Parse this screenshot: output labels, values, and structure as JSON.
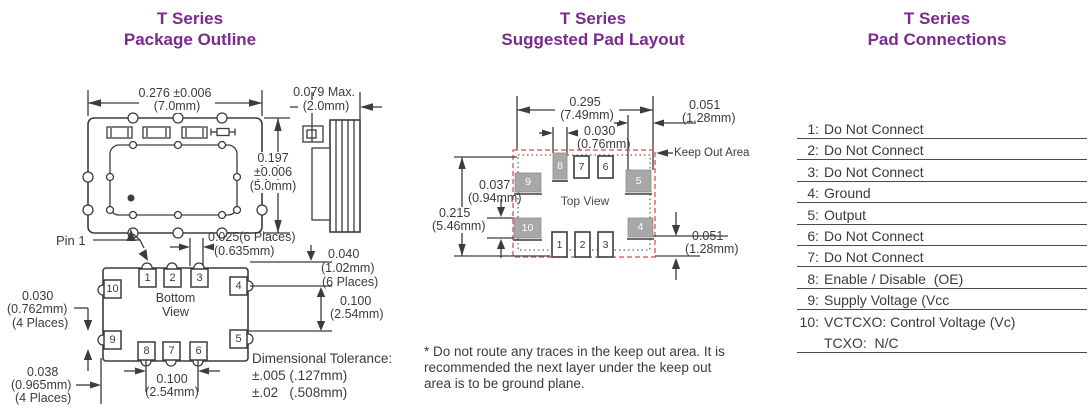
{
  "palette": {
    "purple": "#7a2b8d",
    "ink": "#3b3b3b",
    "pad_gray": "#a8a8a8",
    "keepout_red": "#e26a63"
  },
  "outline": {
    "title1": "T Series",
    "title2": "Package Outline",
    "pin1": "Pin 1",
    "view_label1": "Bottom",
    "view_label2": "View",
    "dims": {
      "width": "0.276 ±0.006",
      "width_mm": "(7.0mm)",
      "height1": "0.197",
      "height2": "±0.006",
      "height3": "(5.0mm)",
      "thick": "0.079 Max.",
      "thick_mm": "(2.0mm)",
      "pad_w": "0.025(6 Places)",
      "pad_w_mm": "(0.635mm)",
      "pad_l": "0.040",
      "pad_l_mm": "(1.02mm)",
      "pad_l_places": "(6 Places)",
      "pitch_r": "0.100",
      "pitch_r_mm": "(2.54mm)",
      "side_pad": "0.030",
      "side_pad_mm": "(0.762mm)",
      "side_pad_places": "(4 Places)",
      "corner": "0.038",
      "corner_mm": "(0.965mm)",
      "corner_places": "(4 Places)",
      "pitch_b": "0.100",
      "pitch_b_mm": "(2.54mm)"
    },
    "tolerance": {
      "line1": "Dimensional Tolerance:",
      "line2": "±.005 (.127mm)",
      "line3": "±.02   (.508mm)"
    },
    "pads": {
      "p1": "1",
      "p2": "2",
      "p3": "3",
      "p4": "4",
      "p5": "5",
      "p6": "6",
      "p7": "7",
      "p8": "8",
      "p9": "9",
      "p10": "10"
    }
  },
  "pad_layout": {
    "title1": "T Series",
    "title2": "Suggested Pad Layout",
    "view_label": "Top View",
    "keep_out": "Keep Out Area",
    "dims": {
      "width": "0.295",
      "width_mm": "(7.49mm)",
      "pad_w": "0.030",
      "pad_w_mm": "(0.76mm)",
      "pad51_top": "0.051",
      "pad51_top_mm": "(1.28mm)",
      "pad37": "0.037",
      "pad37_mm": "(0.94mm)",
      "height": "0.215",
      "height_mm": "(5.46mm)",
      "pad51_bot": "0.051",
      "pad51_bot_mm": "(1.28mm)"
    },
    "pads": {
      "p1": "1",
      "p2": "2",
      "p3": "3",
      "p4": "4",
      "p5": "5",
      "p6": "6",
      "p7": "7",
      "p8": "8",
      "p9": "9",
      "p10": "10"
    },
    "note1": "* Do not route any traces in the keep out area. It is",
    "note2": "recommended the next layer under the keep out",
    "note3": "area is to be ground plane."
  },
  "pad_connections": {
    "title1": "T Series",
    "title2": "Pad Connections",
    "rows": [
      {
        "num": "1:",
        "label": "Do Not Connect"
      },
      {
        "num": "2:",
        "label": "Do Not Connect"
      },
      {
        "num": "3:",
        "label": "Do Not Connect"
      },
      {
        "num": "4:",
        "label": "Ground"
      },
      {
        "num": "5:",
        "label": "Output"
      },
      {
        "num": "6:",
        "label": "Do Not Connect"
      },
      {
        "num": "7:",
        "label": "Do Not Connect"
      },
      {
        "num": "8:",
        "label": "Enable / Disable  (OE)"
      },
      {
        "num": "9:",
        "label": "Supply Voltage (Vcc"
      },
      {
        "num": "10:",
        "label": "VCTCXO: Control Voltage (Vc)"
      },
      {
        "num": "",
        "label": "TCXO:  N/C"
      }
    ]
  }
}
